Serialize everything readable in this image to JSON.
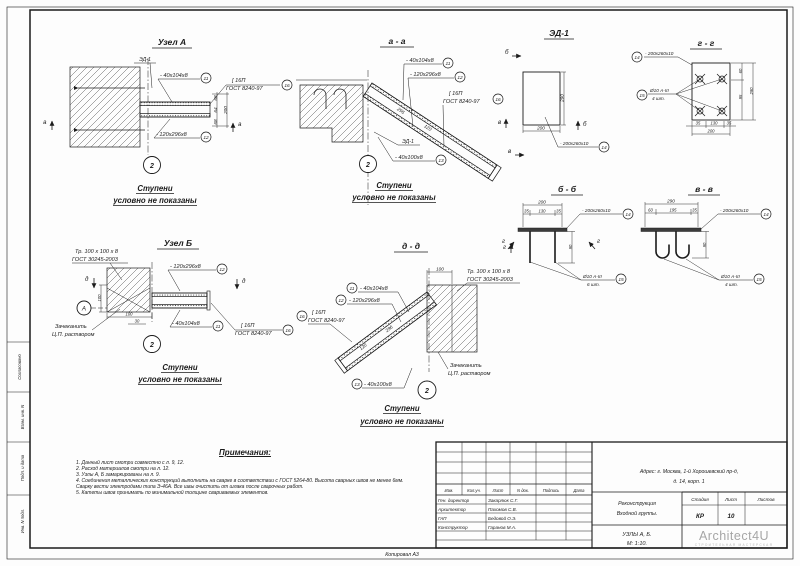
{
  "common": {
    "ed1": "ЭД-1",
    "plate_40_104": "- 40х104х8",
    "plate_120_296": "- 120х296х8",
    "plate_40_100": "- 40х100х8",
    "plate_200_260": "- 200х260х10",
    "channel": "[ 16П",
    "channel_gost": "ГОСТ 8240-97",
    "tube": "Тр. 100 х 100 х 8",
    "tube_gost": "ГОСТ 30245-2003",
    "rebar": "Ø10 А-III",
    "qty4": "4 шт.",
    "qty6": "6 шт.",
    "caulk1": "Зачеканить",
    "caulk2": "Ц.П. раствором",
    "steps1": "Ступени",
    "steps2": "условно не показаны",
    "c2": "2",
    "c11": "11",
    "c12": "12",
    "c13": "13",
    "c14": "14",
    "c15": "15",
    "c16": "16",
    "axis_a": "А"
  },
  "panels": {
    "node_a": {
      "title": "Узел А",
      "section": "а",
      "dims": {
        "h1": "68",
        "h2": "64",
        "h3": "68",
        "total": "200"
      }
    },
    "a_a": {
      "title": "а - а",
      "dims": {
        "len": "296",
        "w": "120"
      }
    },
    "ed1": {
      "title": "ЭД-1",
      "dims": {
        "w": "200",
        "h": "290"
      },
      "sections": {
        "b": "б",
        "v": "в"
      }
    },
    "g_g": {
      "title": "г - г",
      "dims": {
        "r1": "60",
        "r2": "95",
        "rt": "290",
        "b1": "35",
        "b2": "130",
        "b3": "35",
        "bt": "200"
      }
    },
    "b_b": {
      "title": "б - б",
      "section": "г",
      "dims": {
        "t": "200",
        "t1": "35",
        "t2": "130",
        "t3": "35",
        "r": "90"
      }
    },
    "v_v": {
      "title": "в - в",
      "dims": {
        "t": "290",
        "t1": "60",
        "t2": "195",
        "t3": "35",
        "r": "90"
      }
    },
    "node_b": {
      "title": "Узел Б",
      "section": "д",
      "dims": {
        "side": "100",
        "b1": "100",
        "b2": "30"
      }
    },
    "d_d": {
      "title": "д - д",
      "section": "г",
      "dims": {
        "top": "100",
        "len": "296",
        "w": "120"
      }
    }
  },
  "notes": {
    "title": "Примечания:",
    "items": [
      "1. Данный лист смотри совместно с л. 9, 12.",
      "2. Расход материалов смотри на л. 12.",
      "3. Узлы А, Б замаркированы на л. 9.",
      "4. Соединения металлических конструкций выполнить на сварке в соответствии с ГОСТ 5264-80. Высота сварных швов не менее 6мм. Сварку вести электродами типа Э-46А. Все швы очистить от шлака после сварочных работ.",
      "5. Катеты швов принимать по минимальной толщине свариваемых элементов."
    ]
  },
  "stamp": {
    "header": {
      "izm": "Изм.",
      "kol": "Кол.уч.",
      "list": "Лист",
      "ndok": "N док.",
      "podp": "Подпись",
      "data": "Дата"
    },
    "rows": [
      {
        "role": "Ген. директор",
        "name": "Закарлюк С.Г."
      },
      {
        "role": "Архитектор",
        "name": "Пахомов С.В."
      },
      {
        "role": "ГАП",
        "name": "Бедовой О.Э."
      },
      {
        "role": "Конструктор",
        "name": "Гаранов М.А."
      }
    ],
    "address_line1": "Адрес: г. Москва, 1-й Хорошевский пр-д,",
    "address_line2": "д. 14, корп. 1",
    "project_line1": "Реконструкция",
    "project_line2": "Входной группы.",
    "stage_label": "Стадия",
    "stage": "КР",
    "sheet_label": "Лист",
    "sheet": "10",
    "sheets_label": "Листов",
    "content_line1": "УЗЛЫ А, Б.",
    "content_line2": "М: 1:10.",
    "logo": "Architect4U",
    "logo_sub": "СТРОИТЕЛЬНАЯ МАСТЕРСКАЯ"
  },
  "margins": {
    "soglasovano": "Согласовано",
    "vzam": "Взам. инв. N",
    "podp": "Подп. и дата",
    "inv": "Инв. N подл.",
    "copied": "Копировал А3"
  },
  "colors": {
    "line": "#1b1b1b",
    "logo": "#a6a6a6"
  }
}
